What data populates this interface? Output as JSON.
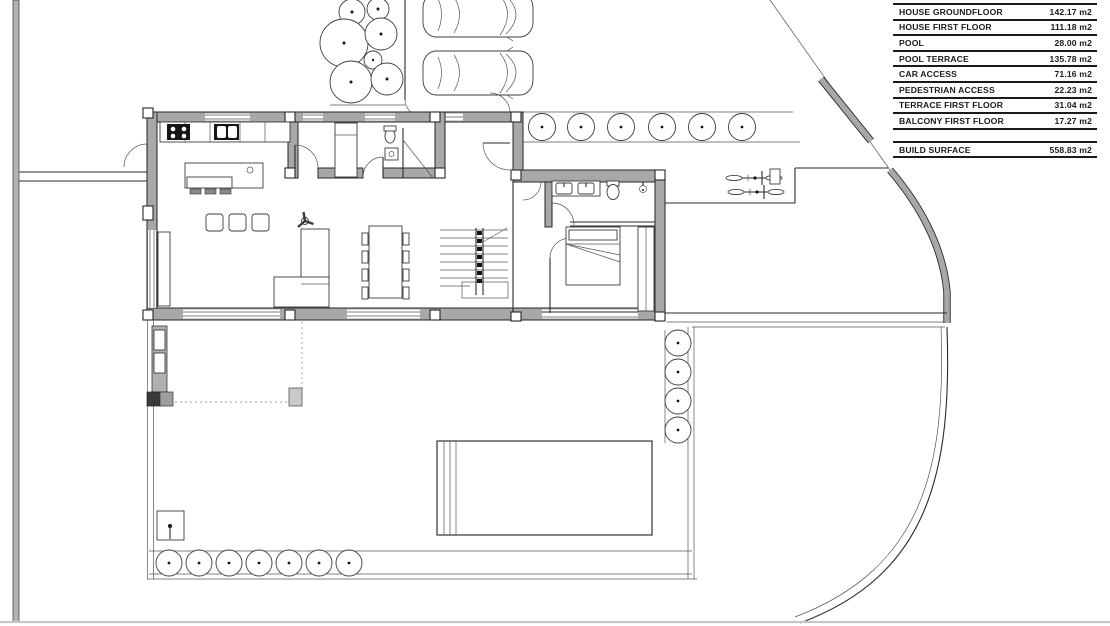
{
  "surface_table": {
    "rows": [
      {
        "label": "HOUSE GROUNDFLOOR",
        "value": "142.17 m2"
      },
      {
        "label": "HOUSE FIRST FLOOR",
        "value": "111.18 m2"
      },
      {
        "label": "POOL",
        "value": "28.00 m2"
      },
      {
        "label": "POOL TERRACE",
        "value": "135.78 m2"
      },
      {
        "label": "CAR ACCESS",
        "value": "71.16 m2"
      },
      {
        "label": "PEDESTRIAN ACCESS",
        "value": "22.23 m2"
      },
      {
        "label": "TERRACE FIRST FLOOR",
        "value": "31.04 m2"
      },
      {
        "label": "BALCONY FIRST FLOOR",
        "value": "17.27 m2"
      }
    ],
    "total": {
      "label": "BUILD SURFACE",
      "value": "558.83 m2"
    }
  },
  "colors": {
    "background": "#ffffff",
    "wall_gray": "#a8a8a8",
    "line_dark": "#2a2a2a",
    "boundary_bottom_gray": "#c6c6c6",
    "table_text": "#1a1a1a"
  },
  "symbols": {
    "tree-icon": "circle-with-center-dot",
    "bush-icon": "small-circle-with-center-dot",
    "car-icon": "car-top-view-outline",
    "bicycle-icon": "bicycle-top-view-outline",
    "ceiling-fan-icon": "three-blade-fan",
    "cooktop-icon": "black-square-four-burners",
    "sink-icon": "black-square-two-basins",
    "toilet-icon": "oval-with-tank",
    "shower-icon": "circle-with-arm",
    "pool": "rectangle-with-step-lines"
  }
}
